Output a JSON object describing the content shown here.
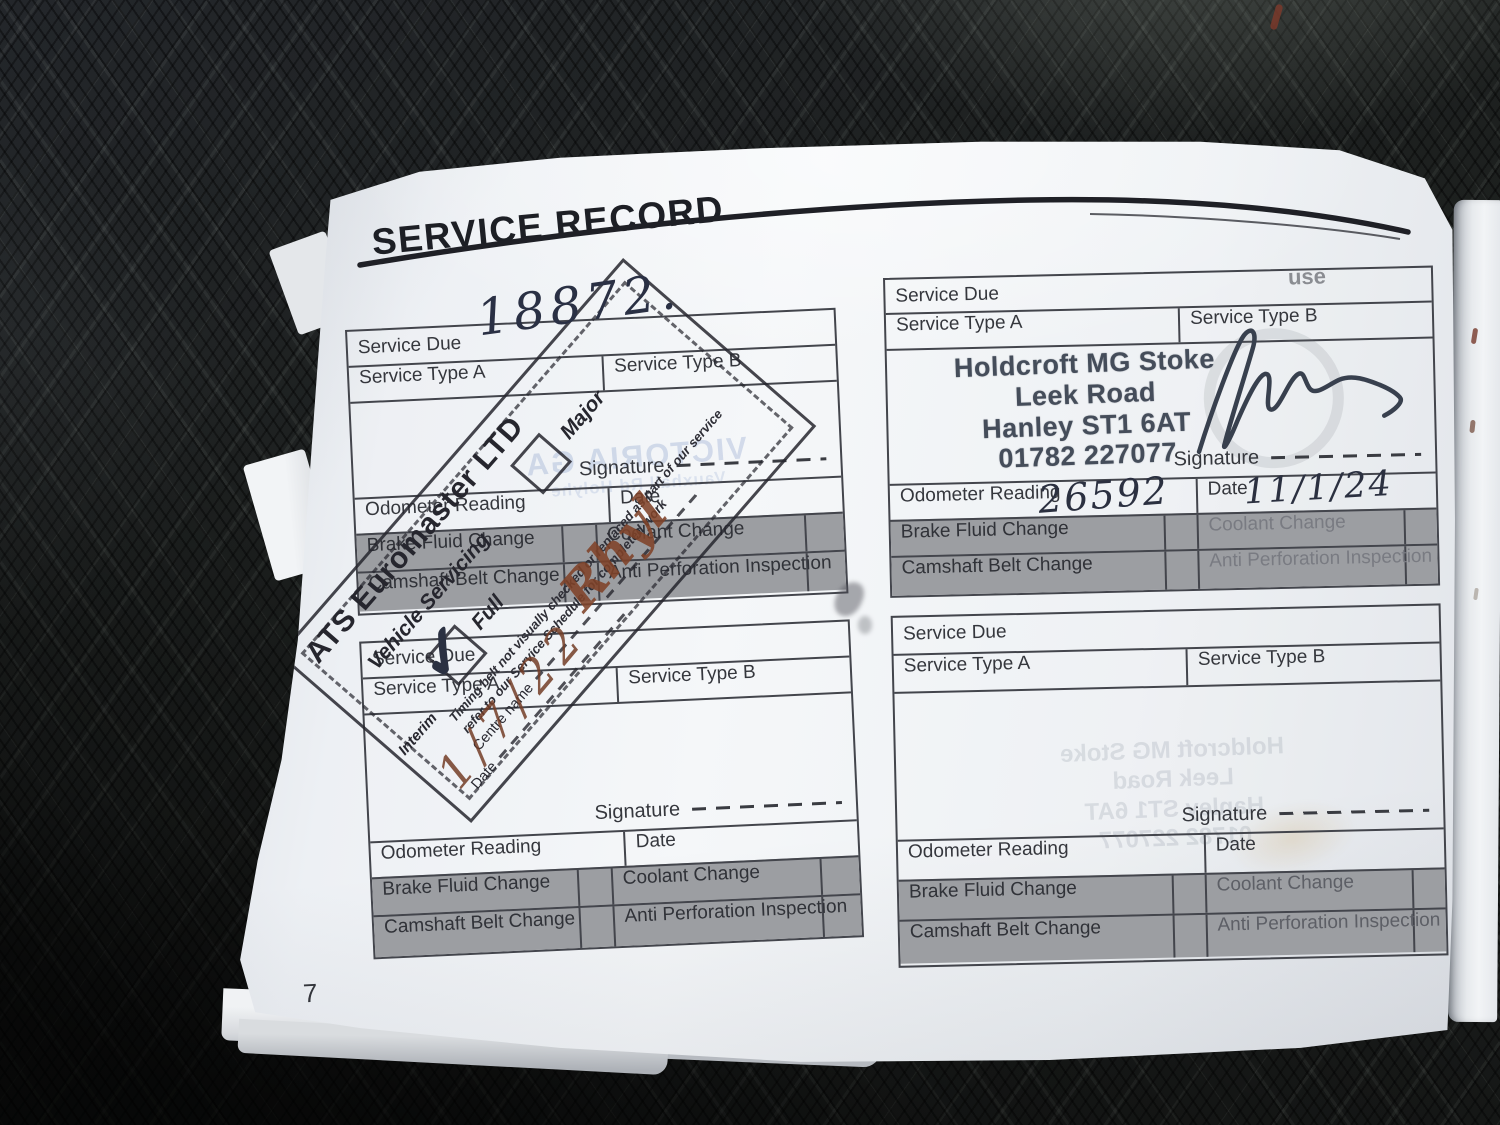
{
  "header": {
    "title": "SERVICE RECORD"
  },
  "page_number": "7",
  "labels": {
    "service_due": "Service Due",
    "service_type_a": "Service Type A",
    "service_type_b": "Service Type B",
    "signature": "Signature",
    "odometer": "Odometer Reading",
    "date": "Date",
    "brake_fluid": "Brake Fluid Change",
    "coolant": "Coolant Change",
    "camshaft": "Camshaft Belt Change",
    "anti_perforation": "Anti Perforation Inspection"
  },
  "stamps": {
    "ats": {
      "company": "ATS Euromaster LTD",
      "vehicle_servicing": "Vehicle Servicing",
      "full": "Full",
      "major": "Major",
      "interim": "Interim",
      "note_line1": "Timing belt not visually checked or replaced as part of our service",
      "note_line2": "refer to our Service Schedule for completed work",
      "centre_label": "Centre name",
      "date_label": "Date",
      "tick": "✓"
    },
    "holdcroft": [
      "Holdcroft MG Stoke",
      "Leek Road",
      "Hanley ST1 6AT",
      "01782 227077"
    ]
  },
  "handwriting": {
    "service_due_value": "18872.",
    "odometer_value": "26592",
    "date_value": "11/1/24",
    "centre_value": "Rhyl",
    "ats_date_value": "1/7/22"
  },
  "ghosts": {
    "victoria": "VICTORIA GA",
    "victoria_line2": "Vauxhall Rd Holyhe",
    "use_fragment": "use",
    "address": [
      "Holdcroft MG Stoke",
      "Leek Road",
      "Hanley ST1 6AT",
      "01782 227077"
    ]
  },
  "colors": {
    "brown_ink": "#7a4028",
    "dark_ink": "#2b3040",
    "holdcroft_stamp_ink": "#454d5a",
    "page_white": "#f5f7f9",
    "fabric_dark": "#1d201f"
  }
}
